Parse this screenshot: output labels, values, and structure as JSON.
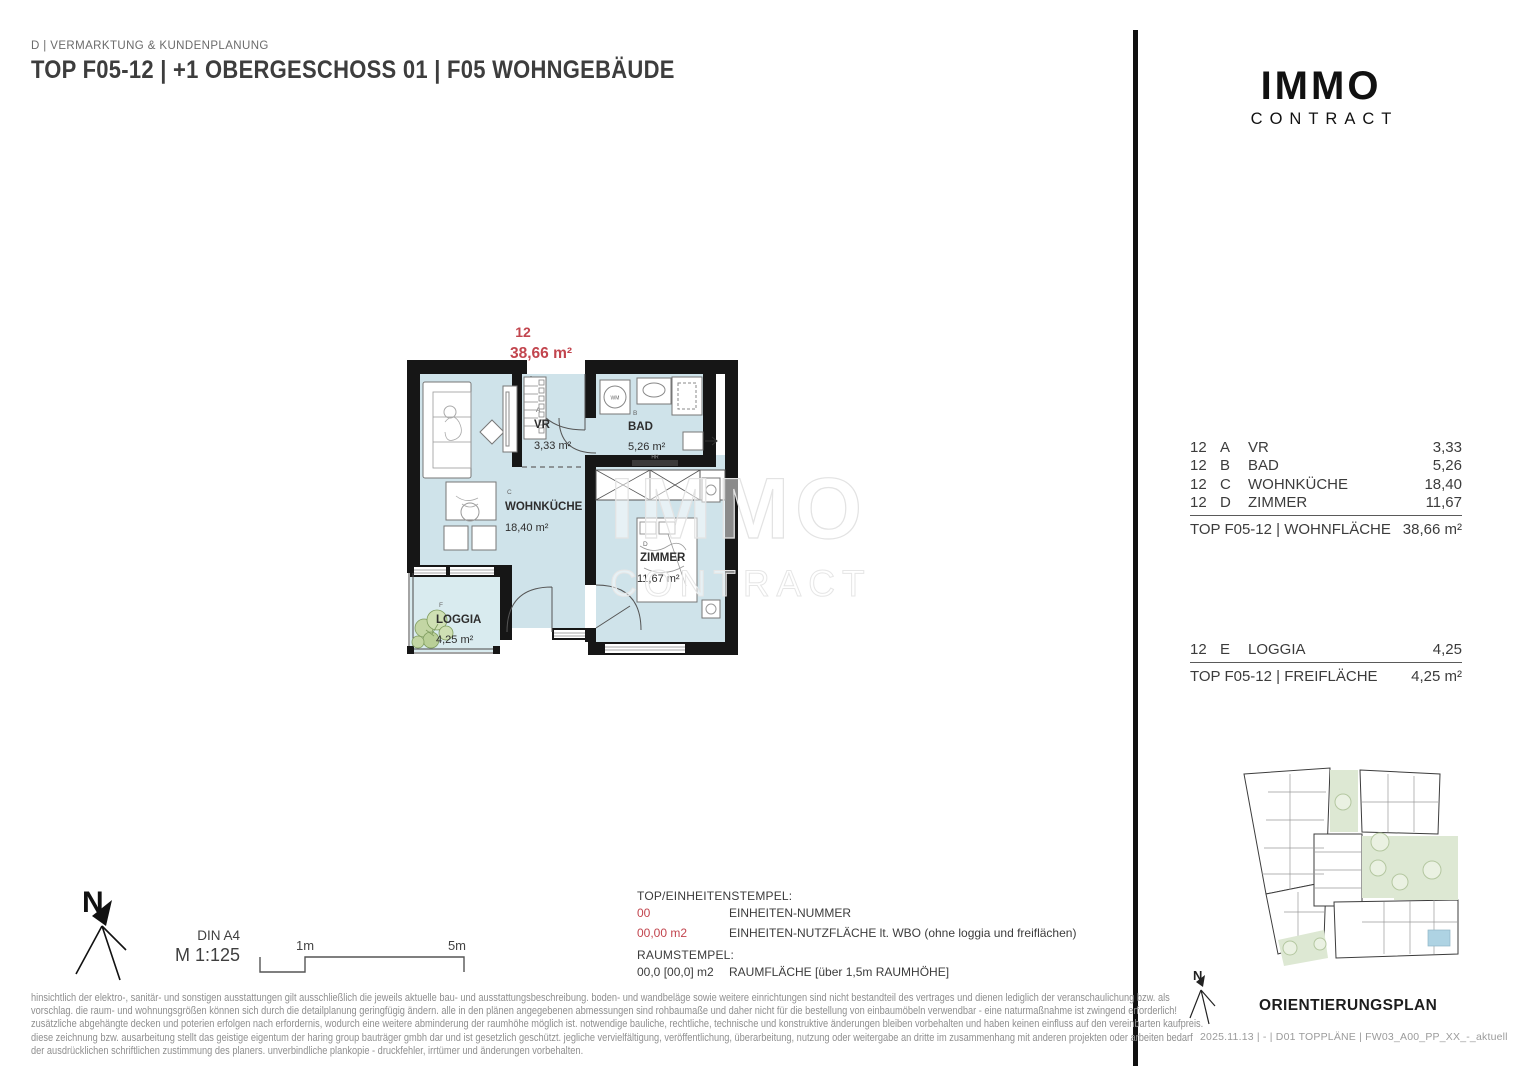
{
  "header": {
    "department": "D | VERMARKTUNG & KUNDENPLANUNG",
    "title": "TOP F05-12 | +1 OBERGESCHOSS 01 | F05 WOHNGEBÄUDE"
  },
  "logo": {
    "line1": "IMMO",
    "line2": "CONTRACT"
  },
  "watermark": {
    "line1": "IMMO",
    "line2": "CONTRACT"
  },
  "plan": {
    "unit_number": "12",
    "unit_area": "38,66 m²",
    "rooms": [
      {
        "letter": "A",
        "name": "VR",
        "area": "3,33 m²"
      },
      {
        "letter": "B",
        "name": "BAD",
        "area": "5,26 m²"
      },
      {
        "letter": "C",
        "name": "WOHNKÜCHE",
        "area": "18,40 m²"
      },
      {
        "letter": "D",
        "name": "ZIMMER",
        "area": "11,67 m²"
      },
      {
        "letter": "F",
        "name": "LOGGIA",
        "area": "4,25 m²"
      }
    ],
    "fixtures": {
      "washing_machine": "WM",
      "heating_rail": "HR"
    }
  },
  "area_table": {
    "rows": [
      {
        "unit": "12",
        "letter": "A",
        "name": "VR",
        "value": "3,33"
      },
      {
        "unit": "12",
        "letter": "B",
        "name": "BAD",
        "value": "5,26"
      },
      {
        "unit": "12",
        "letter": "C",
        "name": "WOHNKÜCHE",
        "value": "18,40"
      },
      {
        "unit": "12",
        "letter": "D",
        "name": "ZIMMER",
        "value": "11,67"
      }
    ],
    "total_label": "TOP F05-12 | WOHNFLÄCHE",
    "total_value": "38,66 m²"
  },
  "free_area_table": {
    "rows": [
      {
        "unit": "12",
        "letter": "E",
        "name": "LOGGIA",
        "value": "4,25"
      }
    ],
    "total_label": "TOP F05-12 | FREIFLÄCHE",
    "total_value": "4,25 m²"
  },
  "scale": {
    "north": "N",
    "paper": "DIN A4",
    "scale_text": "M 1:125",
    "tick_1": "1m",
    "tick_2": "5m"
  },
  "legend": {
    "stamp_title": "TOP/EINHEITENSTEMPEL:",
    "stamp_rows": [
      {
        "sample": "00",
        "desc": "EINHEITEN-NUMMER"
      },
      {
        "sample": "00,00 m2",
        "desc": "EINHEITEN-NUTZFLÄCHE lt. WBO (ohne loggia und freiflächen)"
      }
    ],
    "room_title": "RAUMSTEMPEL:",
    "room_rows": [
      {
        "sample": "00,0 [00,0] m2",
        "desc": "RAUMFLÄCHE [über 1,5m RAUMHÖHE]"
      }
    ]
  },
  "orientation": {
    "title": "ORIENTIERUNGSPLAN",
    "north": "N"
  },
  "footer": {
    "text": "2025.11.13 | - | D01 TOPPLÄNE | FW03_A00_PP_XX_-_aktuell"
  },
  "disclaimer": {
    "lines": [
      "hinsichtlich der elektro-, sanitär- und sonstigen ausstattungen gilt ausschließlich die jeweils aktuelle bau- und ausstattungsbeschreibung. boden- und wandbeläge sowie weitere einrichtungen sind nicht bestandteil des vertrages und dienen lediglich der veranschaulichung bzw. als",
      "vorschlag. die raum- und wohnungsgrößen können sich durch die detailplanung geringfügig ändern. alle in den plänen angegebenen abmessungen sind rohbaumaße und daher nicht für die bestellung von einbaumöbeln verwendbar - eine naturmaßnahme ist zwingend erforderlich!",
      "zusätzliche abgehängte decken und poterien erfolgen nach erfordernis, wodurch eine weitere abminderung der raumhöhe möglich ist. notwendige bauliche, rechtliche, technische und konstruktive änderungen bleiben vorbehalten und haben keinen einfluss auf den vereinbarten kaufpreis.",
      "diese zeichnung bzw. ausarbeitung stellt das geistige eigentum der haring group bauträger gmbh dar und ist gesetzlich geschützt. jegliche vervielfältigung, veröffentlichung, überarbeitung, nutzung oder weitergabe an dritte im zusammenhang mit anderen projekten oder arbeiten bedarf",
      "der ausdrücklichen schriftlichen zustimmung des planers. unverbindliche plankopie - druckfehler, irrtümer und änderungen vorbehalten."
    ]
  },
  "colors": {
    "accent_red": "#c2454e",
    "room_fill": "#cfe3ea",
    "loggia_fill": "#d9ebef",
    "wall": "#161616"
  }
}
